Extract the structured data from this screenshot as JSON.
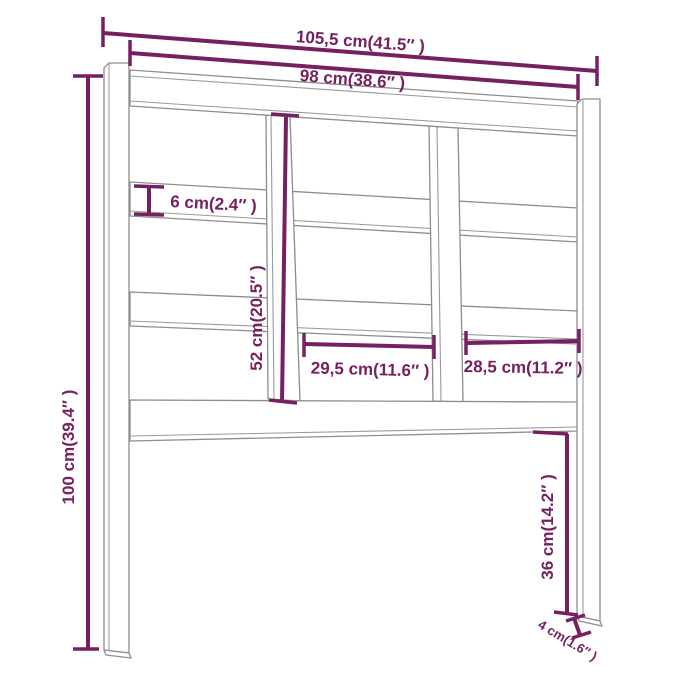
{
  "diagram": {
    "kind": "furniture-dimension-diagram",
    "subject": "bed headboard front view with slats, two dividers and two legs",
    "background_color": "#ffffff",
    "outline_color": "#8d8d8d",
    "dimension_color": "#772061",
    "dimensions": {
      "overall_width": "105,5 cm(41.5″ )",
      "inner_width": "98 cm(38.6″ )",
      "overall_height": "100 cm(39.4″ )",
      "slat_height": "6 cm(2.4″ )",
      "panel_height": "52 cm(20.5″ )",
      "middle_opening_width": "29,5 cm(11.6″ )",
      "right_opening_width": "28,5 cm(11.2″ )",
      "leg_height_below_rail": "36 cm(14.2″ )",
      "leg_depth": "4 cm(1.6″ )"
    }
  }
}
